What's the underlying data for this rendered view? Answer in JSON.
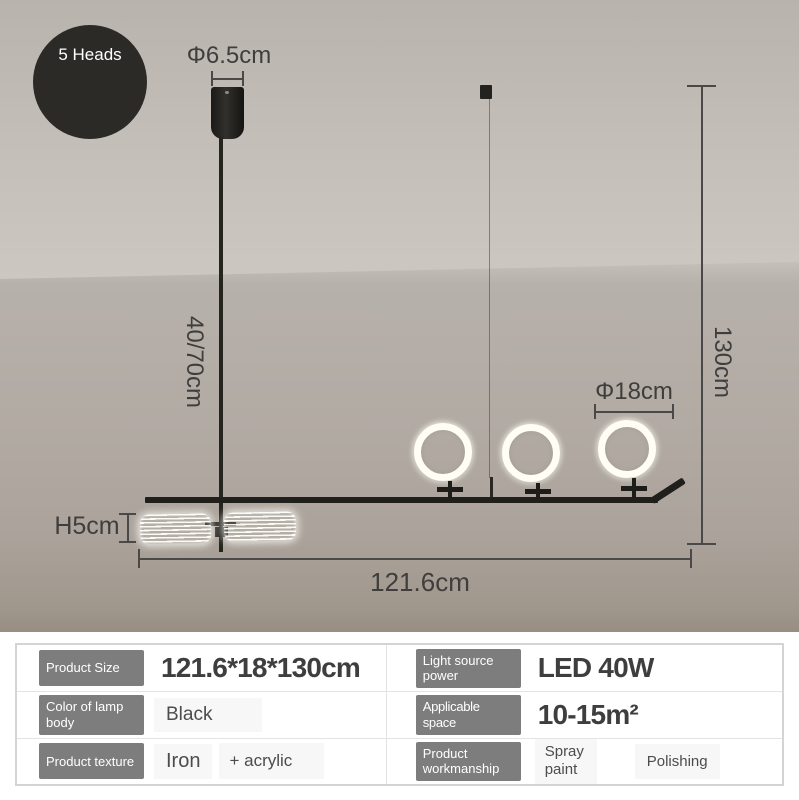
{
  "badge": {
    "label": "5 Heads"
  },
  "annotations": {
    "canopy_diameter": "Φ6.5cm",
    "rod_length": "40/70cm",
    "total_height": "130cm",
    "ring_diameter": "Φ18cm",
    "shade_height": "H5cm",
    "total_width": "121.6cm"
  },
  "specs": {
    "rows": [
      {
        "left": {
          "label": "Product Size",
          "value": "121.6*18*130cm"
        },
        "right": {
          "label": "Light source power",
          "value": "LED 40W"
        }
      },
      {
        "left": {
          "label": "Color of lamp body",
          "value": "Black"
        },
        "right": {
          "label": "Applicable space",
          "value": "10-15m²"
        }
      },
      {
        "left": {
          "label": "Product texture",
          "value": "Iron",
          "value2": "+ acrylic"
        },
        "right": {
          "label": "Product workmanship",
          "value": "Spray paint",
          "value2": "Polishing"
        }
      }
    ]
  },
  "colors": {
    "badge_circle": "#2b2a27",
    "lamp_body": "#211f1c",
    "annotation_text": "#3f3e3c",
    "spec_label_bg": "#7d7d7d",
    "spec_value_box_bg": "#f7f7f7",
    "wall": "#b2aba4",
    "ceiling": "#cdc7c1"
  }
}
